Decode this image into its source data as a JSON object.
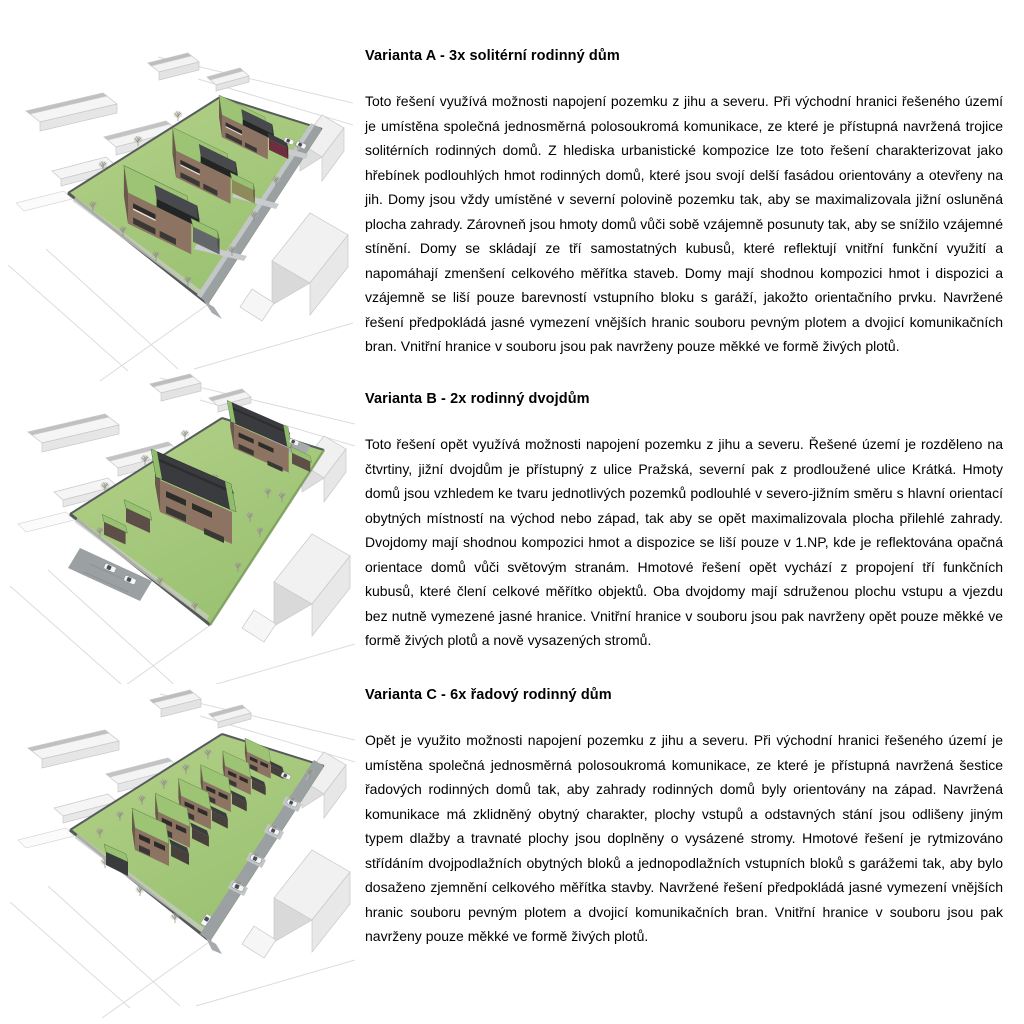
{
  "document": {
    "language": "cs",
    "background": "#ffffff"
  },
  "sections": [
    {
      "heading": "Varianta A - 3x solitérní rodinný dům",
      "body": "Toto řešení využívá možnosti napojení pozemku z jihu a severu. Při východní hranici řešeného území je umístěna společná jednosměrná polosoukromá komunikace, ze které je přístupná navržená trojice solitérních rodinných domů. Z hlediska urbanistické kompozice lze toto řešení charakterizovat jako hřebínek podlouhlých hmot rodinných domů, které jsou svojí delší fasádou orientovány a otevřeny na jih. Domy jsou vždy umístěné v severní polovině pozemku tak, aby se maximalizovala jižní osluněná plocha zahrady. Zárovneň jsou hmoty domů vůči sobě vzájemně posunuty tak, aby se snížilo vzájemné stínění. Domy se skládají ze tří samostatných kubusů, které reflektují vnitřní funkční využití a napomáhají zmenšení celkového měřítka staveb. Domy mají shodnou kompozici hmot i dispozici a vzájemně se liší pouze barevností vstupního bloku s garáží, jakožto orientačního prvku. Navržené řešení předpokládá jasné vymezení vnějších hranic souboru pevným plotem a dvojicí komunikačních bran. Vnitřní hranice v souboru jsou pak navrženy pouze měkké ve formě živých plotů.",
      "figure_icon": "axonometric-site-render-3-detached-houses"
    },
    {
      "heading": "Varianta B - 2x rodinný dvojdům",
      "body": "Toto řešení opět využívá možnosti napojení pozemku z jihu a severu. Řešené území je rozděleno na čtvrtiny, jižní dvojdům je přístupný z ulice Pražská, severní pak z prodloužené ulice Krátká. Hmoty domů jsou vzhledem ke tvaru jednotlivých pozemků podlouhlé v severo-jižním směru s hlavní orientací obytných místností na východ nebo západ, tak aby se opět maximalizovala plocha přilehlé zahrady. Dvojdomy mají shodnou kompozici hmot a dispozice se liší pouze v 1.NP, kde je reflektována opačná orientace domů vůči světovým stranám. Hmotové řešení opět vychází z propojení tří funkčních kubusů, které člení celkové měřítko objektů. Oba dvojdomy mají sdruženou plochu vstupu a vjezdu bez nutně vymezené jasné hranice. Vnitřní hranice v souboru jsou pak navrženy opět pouze měkké ve formě živých plotů a nově vysazených stromů.",
      "figure_icon": "axonometric-site-render-2-semi-detached-houses"
    },
    {
      "heading": "Varianta C - 6x řadový rodinný dům",
      "body": "Opět je využito možnosti napojení pozemku z jihu a severu. Při východní hranici řešeného území je umístěna společná jednosměrná polosoukromá komunikace, ze které je přístupná navržená šestice řadových rodinných domů tak, aby zahrady rodinných domů byly orientovány na západ. Navržená komunikace má zklidněný obytný charakter, plochy vstupů a odstavných stání jsou odlišeny jiným typem dlažby a travnaté plochy jsou doplněny o vysázené stromy. Hmotové řešení je rytmizováno střídáním dvojpodlažních obytných bloků a jednopodlažních vstupních bloků s garážemi tak, aby bylo dosaženo zjemnění celkového měřítka stavby. Navržené řešení předpokládá jasné vymezení vnějších hranic souboru pevným plotem a dvojicí komunikačních bran. Vnitřní hranice v souboru jsou pak navrženy pouze měkké ve formě živých plotů.",
      "figure_icon": "axonometric-site-render-6-row-houses"
    }
  ],
  "render_palette": {
    "grass": "#a7ca7c",
    "green_roof": "#9cc474",
    "brick_wall": "#8d7362",
    "brick_wall_shade": "#6b584c",
    "dark_roof": "#3b3c3f",
    "road": "#9ba0a3",
    "sidewalk": "#c3c6c8",
    "context_building": "#f3f3f3",
    "accent_burgundy": "#6e2e3e",
    "accent_olive": "#8f8a5a",
    "accent_grey": "#64676a"
  }
}
